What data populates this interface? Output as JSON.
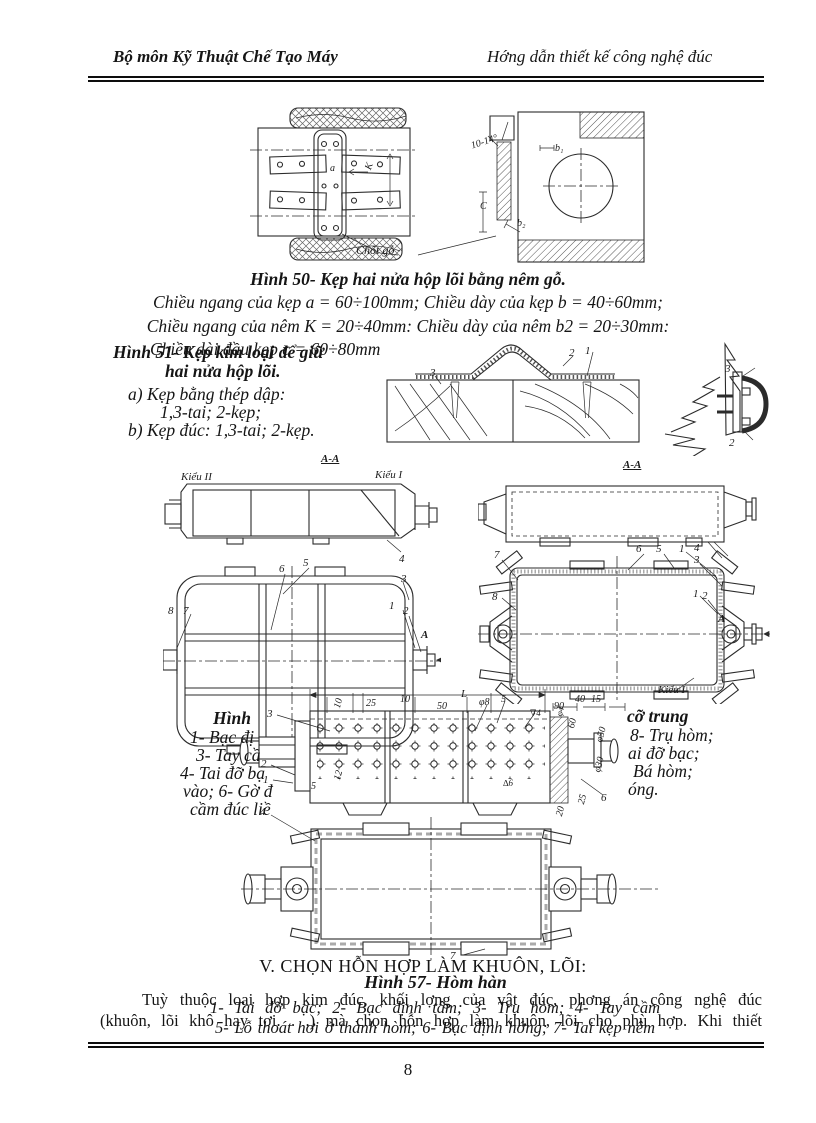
{
  "header": {
    "left": "Bộ môn Kỹ Thuật Chế Tạo Máy",
    "right": "Hớng dẫn thiết kế công nghệ đúc"
  },
  "fig50": {
    "caption": "Hình 50- Kẹp hai nửa hộp lõi bằng nêm gỗ.",
    "note1": "Chiều ngang của kẹp a = 60÷100mm; Chiều dày của kẹp b = 40÷60mm;",
    "note2": "Chiều ngang của nêm K = 20÷40mm: Chiều dày của nêm b2 = 20÷30mm:",
    "note3": "Chiều dài đầu kẹp c = 60÷80mm",
    "labels": [
      {
        "t": "10-14°",
        "x": 220,
        "y": 36,
        "fs": 10,
        "r": -18
      },
      {
        "t": "b₁",
        "x": 305,
        "y": 38,
        "fs": 10
      },
      {
        "t": "C",
        "x": 230,
        "y": 96,
        "fs": 10
      },
      {
        "t": "b₂",
        "x": 267,
        "y": 113,
        "fs": 10
      },
      {
        "t": "Chốt gỗ",
        "x": 106,
        "y": 138,
        "fs": 12
      },
      {
        "t": "a",
        "x": 80,
        "y": 58,
        "fs": 10
      },
      {
        "t": "K",
        "x": 114,
        "y": 62,
        "fs": 10,
        "r": -70
      }
    ]
  },
  "fig51": {
    "caption1": "Hình 51- Kẹp kim loại để giữ",
    "caption2": "hai nửa hộp lõi.",
    "item_a1": "a) Kẹp bằng thép dập:",
    "item_a2": "1,3-tai; 2-kẹp;",
    "item_b": "b) Kẹp đúc: 1,3-tai; 2-kẹp.",
    "labels": [
      {
        "t": "3",
        "x": 95,
        "y": 32
      },
      {
        "t": "2",
        "x": 234,
        "y": 12
      },
      {
        "t": "1",
        "x": 250,
        "y": 10
      },
      {
        "t": "3",
        "x": 390,
        "y": 28
      },
      {
        "t": "2",
        "x": 394,
        "y": 102
      }
    ]
  },
  "fig_mid_left": {
    "labels": [
      {
        "t": "A-A",
        "x": 158,
        "y": 6,
        "u": 1,
        "b": 1
      },
      {
        "t": "Kiểu II",
        "x": 18,
        "y": 24
      },
      {
        "t": "Kiểu I",
        "x": 212,
        "y": 22
      },
      {
        "t": "4",
        "x": 236,
        "y": 106
      },
      {
        "t": "5",
        "x": 140,
        "y": 110
      },
      {
        "t": "6",
        "x": 116,
        "y": 116
      },
      {
        "t": "3",
        "x": 238,
        "y": 126
      },
      {
        "t": "8",
        "x": 5,
        "y": 158
      },
      {
        "t": "7",
        "x": 20,
        "y": 158
      },
      {
        "t": "1",
        "x": 226,
        "y": 153
      },
      {
        "t": "2",
        "x": 240,
        "y": 158
      },
      {
        "t": "A",
        "x": 258,
        "y": 182,
        "b": 1
      }
    ]
  },
  "fig_mid_right": {
    "labels": [
      {
        "t": "A-A",
        "x": 145,
        "y": 22,
        "u": 1,
        "b": 1
      },
      {
        "t": "7",
        "x": 16,
        "y": 112
      },
      {
        "t": "6",
        "x": 158,
        "y": 106
      },
      {
        "t": "5",
        "x": 178,
        "y": 106
      },
      {
        "t": "1",
        "x": 201,
        "y": 106
      },
      {
        "t": "4",
        "x": 216,
        "y": 105
      },
      {
        "t": "3",
        "x": 216,
        "y": 117
      },
      {
        "t": "8",
        "x": 14,
        "y": 154
      },
      {
        "t": "1",
        "x": 215,
        "y": 151
      },
      {
        "t": "2",
        "x": 224,
        "y": 153
      },
      {
        "t": "A",
        "x": 240,
        "y": 176,
        "b": 1
      },
      {
        "t": "Kiểu I",
        "x": 180,
        "y": 247
      }
    ]
  },
  "fig57": {
    "caption_title": "Hình 57- Hòm hàn",
    "cap_left": [
      "Hình",
      "1- Bạc đị",
      "3- Tay cầ",
      "4- Tai đỡ bạ",
      "vào; 6- Gờ đ",
      "cầm đúc liề"
    ],
    "cap_right": [
      "cỡ trung",
      "8- Trụ hòm;",
      "ai đỡ bạc;",
      "Bá hòm;",
      "óng."
    ],
    "cap_over1": "1- Tai đỡ bạc; 2- Bạc định tâm; 3- Trụ hòm; 4- Tay cầm",
    "cap_over2": "5- Lỗ thoát hơi ở thành hòm; 6- Bạc định hớng; 7- Tai kẹp nêm",
    "labels": [
      {
        "t": "L",
        "x": 226,
        "y": 6
      },
      {
        "t": "10",
        "x": 98,
        "y": 24,
        "fs": 10,
        "r": -75
      },
      {
        "t": "25",
        "x": 131,
        "y": 16,
        "fs": 10
      },
      {
        "t": "10",
        "x": 165,
        "y": 12,
        "fs": 10
      },
      {
        "t": "50",
        "x": 202,
        "y": 19,
        "fs": 10
      },
      {
        "t": "φ8",
        "x": 244,
        "y": 15,
        "fs": 10
      },
      {
        "t": "5",
        "x": 266,
        "y": 12,
        "fs": 10
      },
      {
        "t": "∇4",
        "x": 295,
        "y": 26,
        "fs": 9
      },
      {
        "t": "90",
        "x": 319,
        "y": 19,
        "fs": 10
      },
      {
        "t": "40",
        "x": 340,
        "y": 12,
        "fs": 10
      },
      {
        "t": "15",
        "x": 356,
        "y": 12,
        "fs": 10
      },
      {
        "t": "3",
        "x": 32,
        "y": 26
      },
      {
        "t": "2",
        "x": 26,
        "y": 76
      },
      {
        "t": "1",
        "x": 28,
        "y": 92
      },
      {
        "t": "4",
        "x": 25,
        "y": 124
      },
      {
        "t": "5",
        "x": 76,
        "y": 99,
        "fs": 10
      },
      {
        "t": "12",
        "x": 98,
        "y": 96,
        "fs": 10,
        "r": -75
      },
      {
        "t": "∆6",
        "x": 268,
        "y": 96,
        "fs": 9
      },
      {
        "t": "φ4",
        "x": 320,
        "y": 32,
        "fs": 9,
        "r": -75
      },
      {
        "t": "60",
        "x": 332,
        "y": 44,
        "fs": 10,
        "r": -75
      },
      {
        "t": "φ50",
        "x": 360,
        "y": 58,
        "fs": 10,
        "r": -75
      },
      {
        "t": "φ30",
        "x": 358,
        "y": 88,
        "fs": 10,
        "r": -75
      },
      {
        "t": "25",
        "x": 342,
        "y": 120,
        "fs": 10,
        "r": -75
      },
      {
        "t": "20",
        "x": 320,
        "y": 132,
        "fs": 10,
        "r": -75
      },
      {
        "t": "6",
        "x": 366,
        "y": 110
      },
      {
        "t": "7",
        "x": 215,
        "y": 268
      }
    ]
  },
  "section_v": {
    "heading": "V. CHỌN HỖN HỢP LÀM KHUÔN, LÕI:",
    "para1": "Tuỳ thuộc loại hợp kim đúc, khối lợng của vật đúc, phơng án công nghệ đúc",
    "para2": "(khuôn, lõi khô hay tơi. . .) mà chọn hỗn hợp làm khuôn, lõi cho phù hợp. Khi thiết"
  },
  "footer": {
    "page_number": "8"
  }
}
